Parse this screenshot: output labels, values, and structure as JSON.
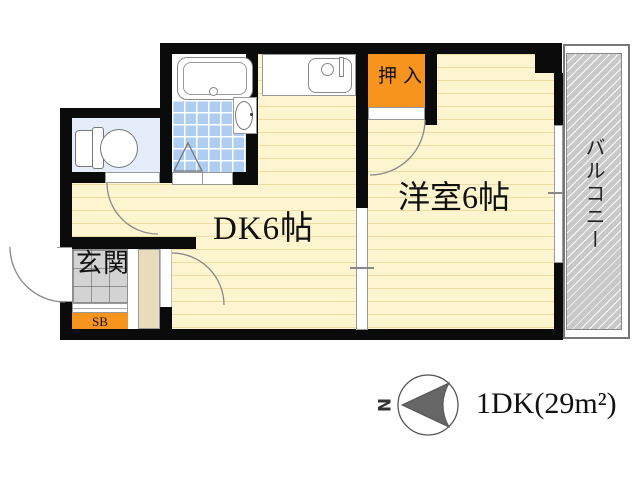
{
  "title": "1DK floor plan",
  "rooms": {
    "dk": "DK6帖",
    "western": "洋室6帖",
    "closet": "押入",
    "entrance": "玄関",
    "shoebox": "SB",
    "balcony": "バルコニー"
  },
  "compass": {
    "north": "N"
  },
  "area_label": "1DK(29m²)",
  "colors": {
    "wall": "#0b0b0b",
    "floor": "#FCF5D0",
    "floor_stripe": "#EFDCA2",
    "closet_orange": "#F7941D",
    "bath_tile_blue": "#ADCDF1",
    "toilet_floor_blue": "#E4EDF9",
    "entrance_tile_gray": "#D3D3D3",
    "partition_tan": "#E8DCBC",
    "balcony_gray": "#C9C9C9"
  }
}
